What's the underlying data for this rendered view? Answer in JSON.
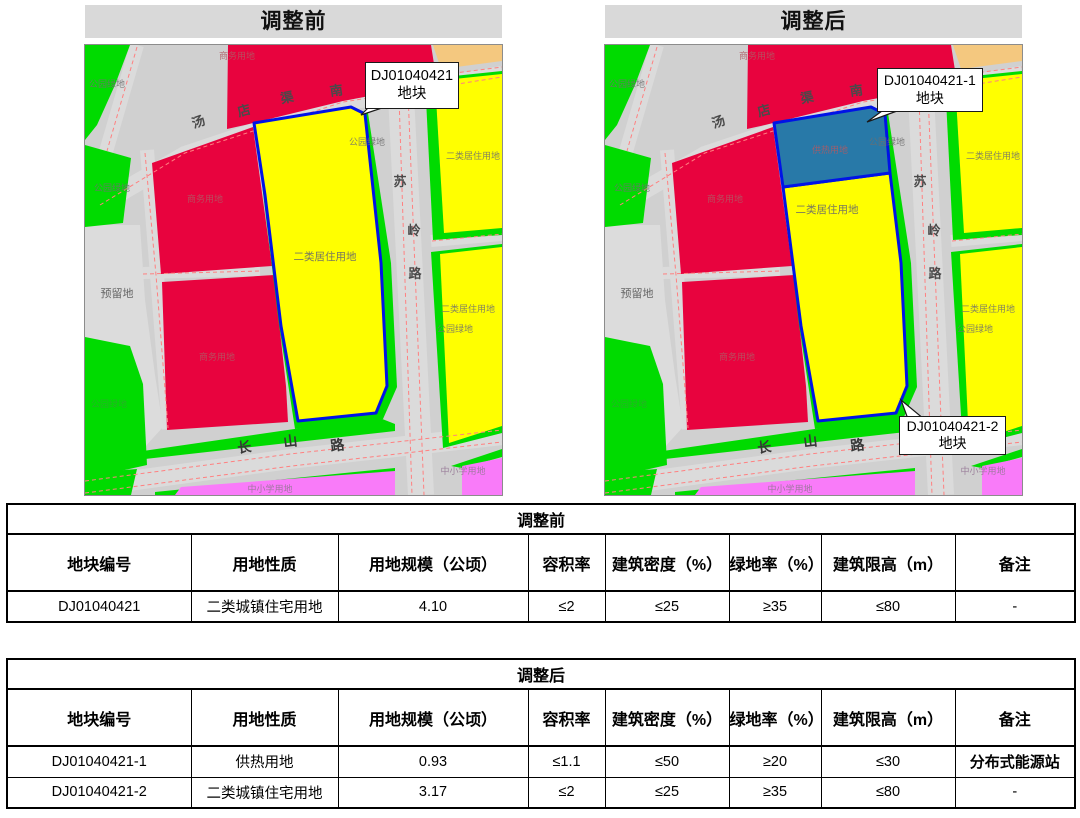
{
  "palette": {
    "road": "#D0D0D0",
    "roadlite": "#DBDBDB",
    "reserved": "#DCDCDC",
    "green": "#00DB00",
    "red": "#E8033E",
    "yellow": "#FFFF00",
    "orange": "#F4C87F",
    "pink": "#F97BF9",
    "heat": "#2879A8",
    "outline": "#0013E6",
    "titlebg": "#D9D9D9"
  },
  "panels": {
    "before_title": "调整前",
    "after_title": "调整后"
  },
  "maps": {
    "before": {
      "callouts": [
        {
          "line1": "DJ01040421",
          "line2": "地块"
        }
      ],
      "labels": [
        {
          "t": "公园绿地",
          "x": 22,
          "y": 42,
          "c": "ly"
        },
        {
          "t": "商务用地",
          "x": 152,
          "y": 14,
          "c": "lr"
        },
        {
          "t": "汤",
          "x": 115,
          "y": 81,
          "c": "ld",
          "r": -20
        },
        {
          "t": "店",
          "x": 160,
          "y": 70,
          "c": "ld",
          "r": -15
        },
        {
          "t": "渠",
          "x": 203,
          "y": 57,
          "c": "ld",
          "r": -12
        },
        {
          "t": "南",
          "x": 252,
          "y": 50,
          "c": "ld",
          "r": -8
        },
        {
          "t": "公园绿地",
          "x": 282,
          "y": 100,
          "c": "ly"
        },
        {
          "t": "二类居住用地",
          "x": 388,
          "y": 114,
          "c": "ly"
        },
        {
          "t": "公园绿地",
          "x": 27,
          "y": 146,
          "c": "ly"
        },
        {
          "t": "商务用地",
          "x": 120,
          "y": 157,
          "c": "lr"
        },
        {
          "t": "预留地",
          "x": 32,
          "y": 252,
          "c": "ld2"
        },
        {
          "t": "二类居住用地",
          "x": 240,
          "y": 215,
          "c": "ly2"
        },
        {
          "t": "苏",
          "x": 315,
          "y": 141,
          "c": "ld"
        },
        {
          "t": "岭",
          "x": 329,
          "y": 190,
          "c": "ld"
        },
        {
          "t": "路",
          "x": 330,
          "y": 233,
          "c": "ld"
        },
        {
          "t": "公园绿地",
          "x": 24,
          "y": 362,
          "c": "lg"
        },
        {
          "t": "商务用地",
          "x": 132,
          "y": 315,
          "c": "lr"
        },
        {
          "t": "二类居住用地",
          "x": 383,
          "y": 267,
          "c": "ly"
        },
        {
          "t": "公园绿地",
          "x": 370,
          "y": 287,
          "c": "ly"
        },
        {
          "t": "长",
          "x": 160,
          "y": 407,
          "c": "ld3",
          "r": -7
        },
        {
          "t": "山",
          "x": 206,
          "y": 401,
          "c": "ld3",
          "r": -7
        },
        {
          "t": "路",
          "x": 253,
          "y": 405,
          "c": "ld3",
          "r": -7
        },
        {
          "t": "中小学用地",
          "x": 378,
          "y": 429,
          "c": "lp"
        },
        {
          "t": "中小学用地",
          "x": 185,
          "y": 447,
          "c": "lp"
        }
      ]
    },
    "after": {
      "callouts": [
        {
          "line1": "DJ01040421-1",
          "line2": "地块"
        },
        {
          "line1": "DJ01040421-2",
          "line2": "地块"
        }
      ],
      "labels": [
        {
          "t": "公园绿地",
          "x": 22,
          "y": 42,
          "c": "ly"
        },
        {
          "t": "商务用地",
          "x": 152,
          "y": 14,
          "c": "lr"
        },
        {
          "t": "汤",
          "x": 115,
          "y": 81,
          "c": "ld",
          "r": -20
        },
        {
          "t": "店",
          "x": 160,
          "y": 70,
          "c": "ld",
          "r": -15
        },
        {
          "t": "渠",
          "x": 203,
          "y": 57,
          "c": "ld",
          "r": -12
        },
        {
          "t": "南",
          "x": 252,
          "y": 50,
          "c": "ld",
          "r": -8
        },
        {
          "t": "供热用地",
          "x": 225,
          "y": 108,
          "c": "lr"
        },
        {
          "t": "公园绿地",
          "x": 282,
          "y": 100,
          "c": "ly"
        },
        {
          "t": "二类居住用地",
          "x": 222,
          "y": 168,
          "c": "ly2"
        },
        {
          "t": "二类居住用地",
          "x": 388,
          "y": 114,
          "c": "ly"
        },
        {
          "t": "公园绿地",
          "x": 27,
          "y": 146,
          "c": "ly"
        },
        {
          "t": "商务用地",
          "x": 120,
          "y": 157,
          "c": "lr"
        },
        {
          "t": "预留地",
          "x": 32,
          "y": 252,
          "c": "ld2"
        },
        {
          "t": "苏",
          "x": 315,
          "y": 141,
          "c": "ld"
        },
        {
          "t": "岭",
          "x": 329,
          "y": 190,
          "c": "ld"
        },
        {
          "t": "路",
          "x": 330,
          "y": 233,
          "c": "ld"
        },
        {
          "t": "公园绿地",
          "x": 24,
          "y": 362,
          "c": "lg"
        },
        {
          "t": "商务用地",
          "x": 132,
          "y": 315,
          "c": "lr"
        },
        {
          "t": "二类居住用地",
          "x": 383,
          "y": 267,
          "c": "ly"
        },
        {
          "t": "公园绿地",
          "x": 370,
          "y": 287,
          "c": "ly"
        },
        {
          "t": "长",
          "x": 160,
          "y": 407,
          "c": "ld3",
          "r": -7
        },
        {
          "t": "山",
          "x": 206,
          "y": 401,
          "c": "ld3",
          "r": -7
        },
        {
          "t": "路",
          "x": 253,
          "y": 405,
          "c": "ld3",
          "r": -7
        },
        {
          "t": "中小学用地",
          "x": 378,
          "y": 429,
          "c": "lp"
        },
        {
          "t": "中小学用地",
          "x": 185,
          "y": 447,
          "c": "lp"
        }
      ]
    }
  },
  "tables": {
    "before": {
      "title": "调整前",
      "columns": [
        "地块编号",
        "用地性质",
        "用地规模（公顷）",
        "容积率",
        "建筑密度（%）",
        "绿地率（%）",
        "建筑限高（m）",
        "备注"
      ],
      "rows": [
        [
          "DJ01040421",
          "二类城镇住宅用地",
          "4.10",
          "≤2",
          "≤25",
          "≥35",
          "≤80",
          "-"
        ]
      ]
    },
    "after": {
      "title": "调整后",
      "columns": [
        "地块编号",
        "用地性质",
        "用地规模（公顷）",
        "容积率",
        "建筑密度（%）",
        "绿地率（%）",
        "建筑限高（m）",
        "备注"
      ],
      "rows": [
        [
          "DJ01040421-1",
          "供热用地",
          "0.93",
          "≤1.1",
          "≤50",
          "≥20",
          "≤30",
          "分布式能源站"
        ],
        [
          "DJ01040421-2",
          "二类城镇住宅用地",
          "3.17",
          "≤2",
          "≤25",
          "≥35",
          "≤80",
          "-"
        ]
      ]
    }
  }
}
